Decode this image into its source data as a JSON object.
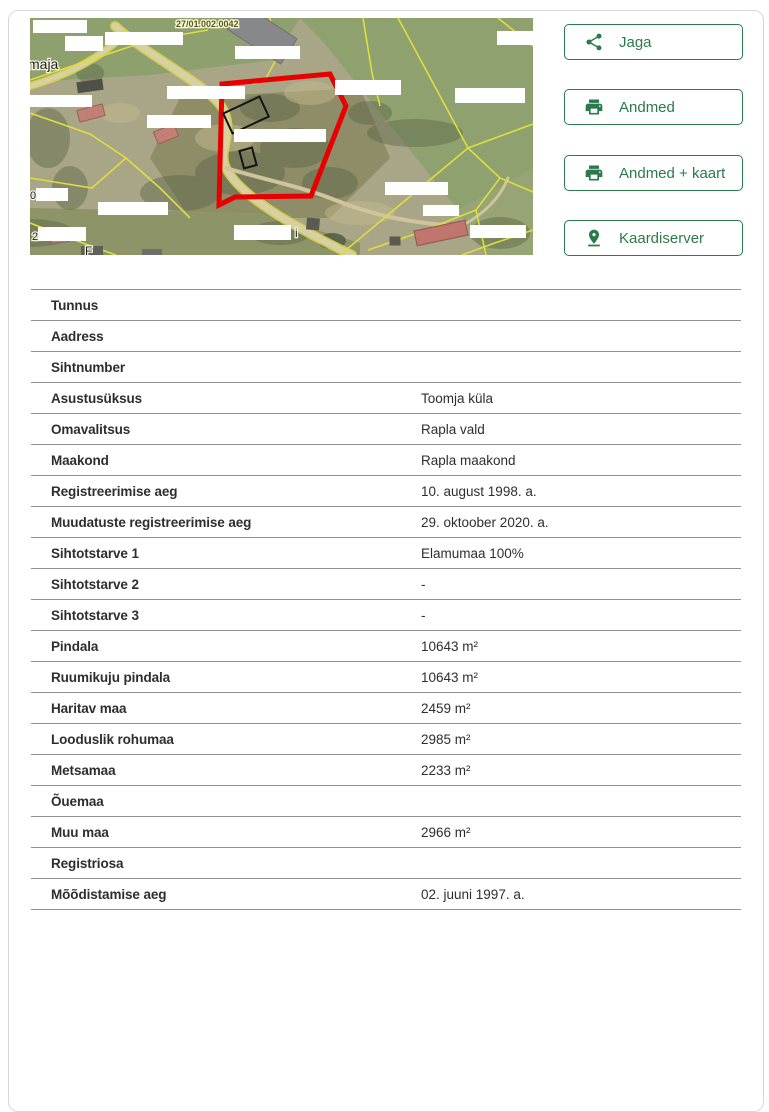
{
  "colors": {
    "accent_green": "#2b7a4b",
    "parcel_red": "#e80000",
    "cadastral_yellow": "#dede3c",
    "table_line_gray": "#929292"
  },
  "map": {
    "name": "cadastral-aerial-map",
    "labels": {
      "cadastral_code": "27/01.002.0042",
      "partial_left": "maja",
      "glyph_mid_left": "0",
      "glyph_bottom_left": "2",
      "glyph_bottom": "F",
      "glyph_bottom_center": "i"
    }
  },
  "actions": {
    "0": {
      "label": "Jaga",
      "icon": "share-icon"
    },
    "1": {
      "label": "Andmed",
      "icon": "printer-icon"
    },
    "2": {
      "label": "Andmed + kaart",
      "icon": "printer-icon"
    },
    "3": {
      "label": "Kaardiserver",
      "icon": "pin-drop-icon"
    }
  },
  "table": {
    "rows": [
      {
        "label": "Tunnus",
        "value": ""
      },
      {
        "label": "Aadress",
        "value": ""
      },
      {
        "label": "Sihtnumber",
        "value": ""
      },
      {
        "label": "Asustusüksus",
        "value": "Toomja küla"
      },
      {
        "label": "Omavalitsus",
        "value": "Rapla vald"
      },
      {
        "label": "Maakond",
        "value": "Rapla maakond"
      },
      {
        "label": "Registreerimise aeg",
        "value": "10. august 1998. a."
      },
      {
        "label": "Muudatuste registreerimise aeg",
        "value": "29. oktoober 2020. a."
      },
      {
        "label": "Sihtotstarve 1",
        "value": "Elamumaa 100%"
      },
      {
        "label": "Sihtotstarve 2",
        "value": "-"
      },
      {
        "label": "Sihtotstarve 3",
        "value": "-"
      },
      {
        "label": "Pindala",
        "value": "10643 m²"
      },
      {
        "label": "Ruumikuju pindala",
        "value": "10643 m²"
      },
      {
        "label": "Haritav maa",
        "value": "2459 m²"
      },
      {
        "label": "Looduslik rohumaa",
        "value": "2985 m²"
      },
      {
        "label": "Metsamaa",
        "value": "2233 m²"
      },
      {
        "label": "Õuemaa",
        "value": ""
      },
      {
        "label": "Muu maa",
        "value": "2966 m²"
      },
      {
        "label": "Registriosa",
        "value": ""
      },
      {
        "label": "Mõõdistamise aeg",
        "value": "02. juuni 1997. a."
      }
    ]
  }
}
